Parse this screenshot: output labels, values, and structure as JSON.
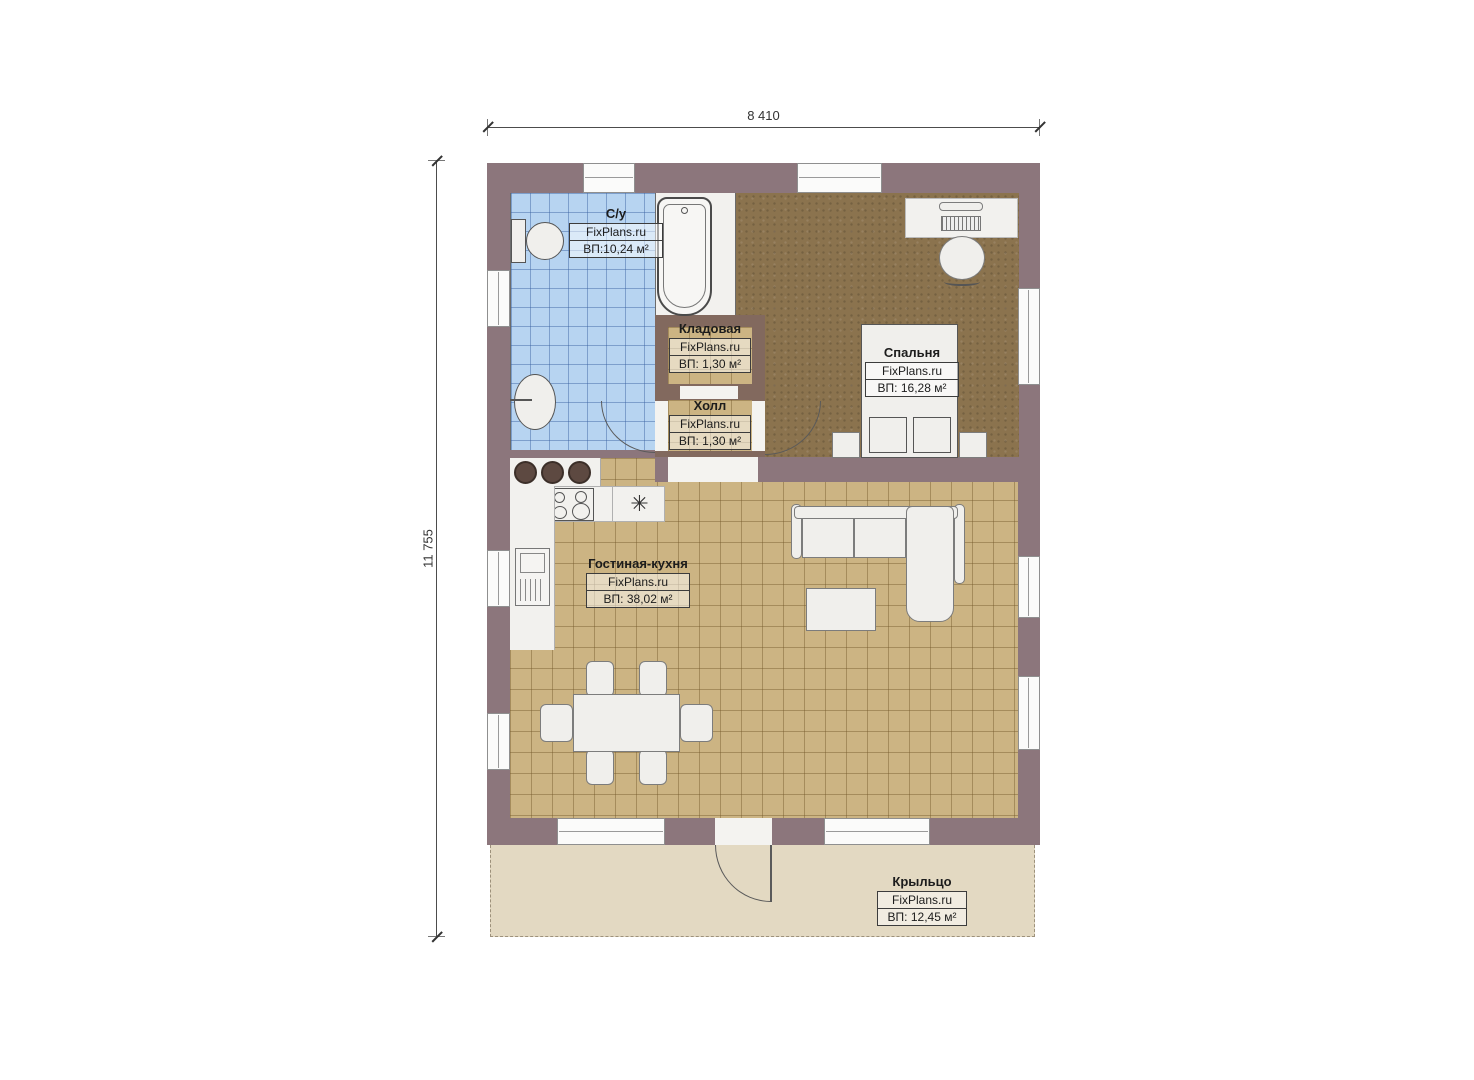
{
  "dimensions": {
    "width_label": "8 410",
    "height_label": "11 755"
  },
  "brand": "FixPlans.ru",
  "rooms": {
    "bathroom": {
      "name": "С/у",
      "brand": "FixPlans.ru",
      "area": "ВП:10,24 м²"
    },
    "storage": {
      "name": "Кладовая",
      "brand": "FixPlans.ru",
      "area": "ВП: 1,30 м²"
    },
    "hall": {
      "name": "Холл",
      "brand": "FixPlans.ru",
      "area": "ВП: 1,30 м²"
    },
    "bedroom": {
      "name": "Спальня",
      "brand": "FixPlans.ru",
      "area": "ВП: 16,28 м²"
    },
    "living": {
      "name": "Гостиная-кухня",
      "brand": "FixPlans.ru",
      "area": "ВП: 38,02 м²"
    },
    "porch": {
      "name": "Крыльцо",
      "brand": "FixPlans.ru",
      "area": "ВП: 12,45 м²"
    }
  },
  "icons": {
    "kitchen_sink": "✳"
  },
  "colors": {
    "wall": "#8c767c",
    "wall_inner": "#82695e",
    "bath_floor": "#b7d4f1",
    "bedroom_floor": "#8b734e",
    "living_floor": "#ccb483",
    "porch_floor": "#e3d9c2"
  }
}
